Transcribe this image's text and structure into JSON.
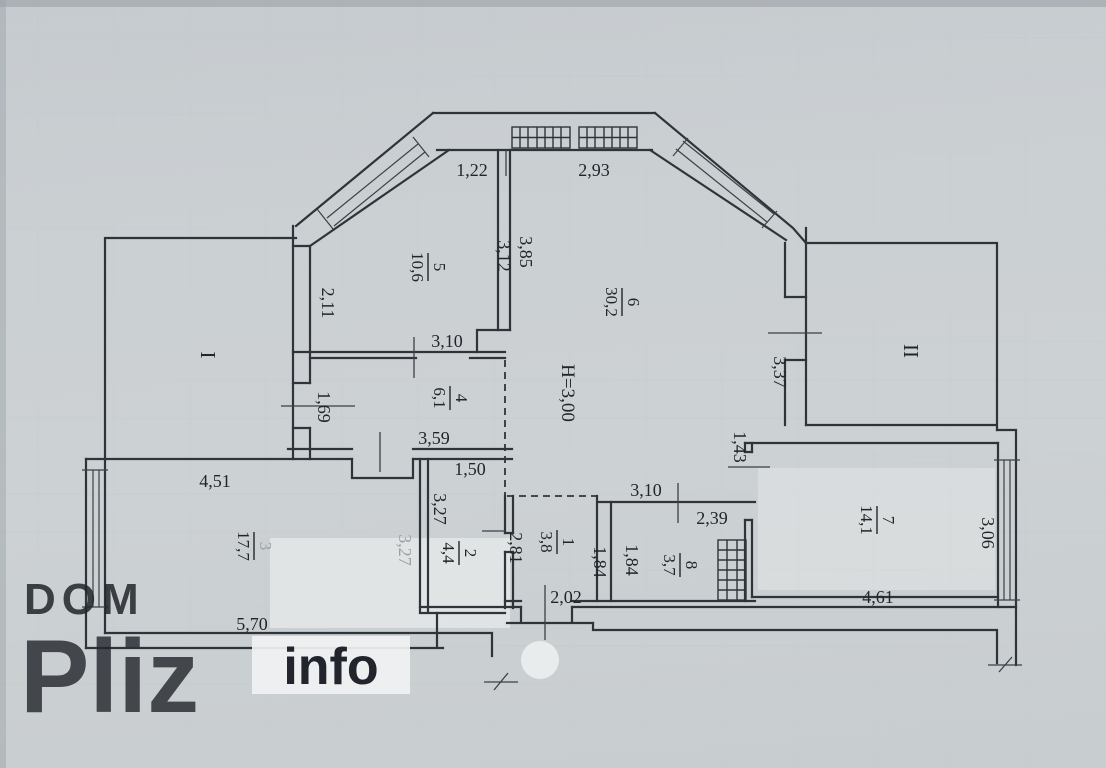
{
  "watermark": {
    "line1": "DOM",
    "line2": "Pliz",
    "line3": "info"
  },
  "plan": {
    "height_note": "H=3,00",
    "balcony_left_label": "I",
    "balcony_right_label": "II",
    "rooms": [
      {
        "num": "1",
        "area": "3,8"
      },
      {
        "num": "2",
        "area": "4,4"
      },
      {
        "num": "3",
        "area": "17,7"
      },
      {
        "num": "4",
        "area": "6,1"
      },
      {
        "num": "5",
        "area": "10,6"
      },
      {
        "num": "6",
        "area": "30,2"
      },
      {
        "num": "7",
        "area": "14,1"
      },
      {
        "num": "8",
        "area": "3,7"
      }
    ],
    "dims": {
      "bay_left": "1,22",
      "bay_right": "2,93",
      "room5_h": "3,12",
      "room6_h": "3,85",
      "room5_left": "2,11",
      "room5_w": "3,10",
      "room4_door": "1,69",
      "room4_w": "3,59",
      "room2_w": "1,50",
      "room2_h": "3,27",
      "room2_right": "2,81",
      "room3_top": "4,51",
      "room3_bottom": "5,70",
      "room3_right": "3,27",
      "room1_h": "1,84",
      "room8_h": "1,84",
      "room1_w": "2,02",
      "room8_top": "3,10",
      "room8_w": "2,39",
      "room6_right": "3,37",
      "room7_door": "1,43",
      "room7_w": "4,61",
      "room7_h": "3,06"
    }
  }
}
